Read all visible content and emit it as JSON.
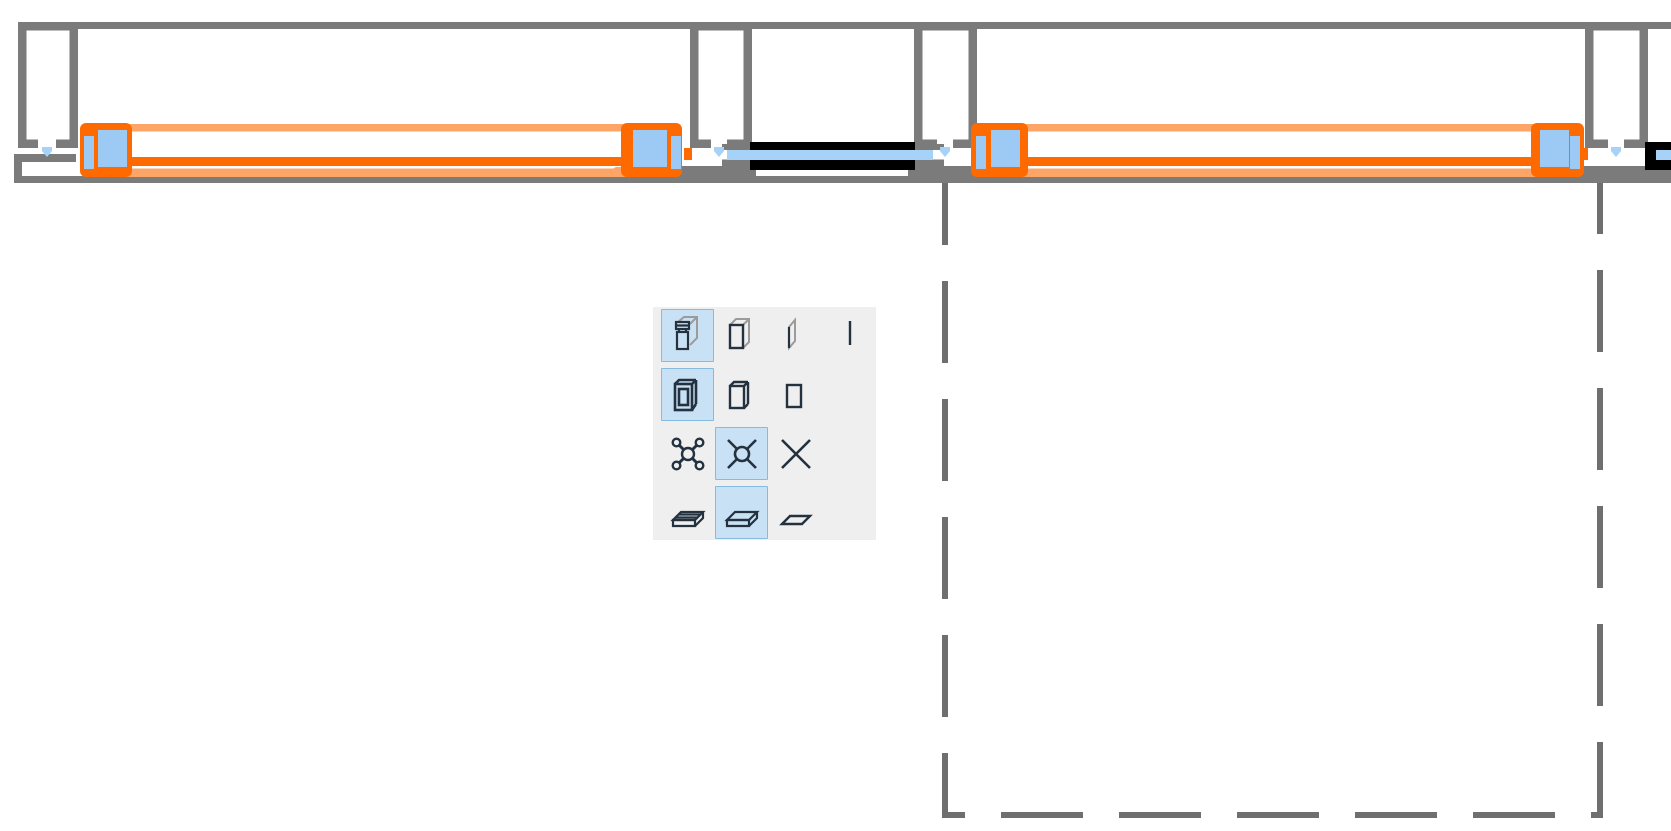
{
  "app": {
    "view": "plan-detail-view",
    "description": "CAD plan view of a wall with glazed openings; two window elements selected (orange) with blue grab handles, one unselected window (black), a dashed selection marquee and a floating display-option palette"
  },
  "colors": {
    "canvas_bg": "#ffffff",
    "wall_gray": "#7b7b7b",
    "marquee_gray": "#6f6f6f",
    "selection_orange": "#ff6a00",
    "selection_orange_light": "#fca566",
    "handle_blue": "#9ccaf5",
    "glass_blue": "#a6d2f8",
    "window_black": "#000000",
    "palette_bg": "#efefef",
    "palette_selected_bg": "#c9e1f4",
    "palette_selected_border": "#85bbe0",
    "icon_dark": "#243240",
    "icon_gray": "#9b9b9b"
  },
  "drawing": {
    "wall": {
      "top_edge_y": 22,
      "bottom_edge_y": 183,
      "piers_x": [
        18,
        690,
        914,
        1585
      ]
    },
    "windows": [
      {
        "state": "selected",
        "x_start": 80,
        "x_end": 682,
        "handles": 2
      },
      {
        "state": "unselected",
        "x_start": 727,
        "x_end": 933
      },
      {
        "state": "selected",
        "x_start": 971,
        "x_end": 1584,
        "handles": 2
      },
      {
        "state": "unselected-partial",
        "x_start": 1645,
        "x_end": 1671
      }
    ],
    "anchor_marks": 4,
    "marquee": {
      "left": 945,
      "top": 183,
      "right": 1600,
      "bottom": 815,
      "style": "dashed"
    }
  },
  "palette": {
    "rows": [
      {
        "cells": [
          {
            "icon": "box-3d-detailed-icon",
            "selected": true
          },
          {
            "icon": "box-3d-simple-icon",
            "selected": false
          },
          {
            "icon": "panel-3d-icon",
            "selected": false
          },
          {
            "icon": "line-2d-icon",
            "selected": false
          }
        ]
      },
      {
        "cells": [
          {
            "icon": "frame-3d-detailed-icon",
            "selected": true
          },
          {
            "icon": "frame-3d-simple-icon",
            "selected": false
          },
          {
            "icon": "rectangle-2d-icon",
            "selected": false
          }
        ]
      },
      {
        "cells": [
          {
            "icon": "cross-nodes-detailed-icon",
            "selected": false
          },
          {
            "icon": "cross-node-simple-icon",
            "selected": true
          },
          {
            "icon": "cross-plain-icon",
            "selected": false
          }
        ]
      },
      {
        "cells": [
          {
            "icon": "slab-3d-detailed-icon",
            "selected": false
          },
          {
            "icon": "slab-3d-simple-icon",
            "selected": true
          },
          {
            "icon": "slab-flat-icon",
            "selected": false
          }
        ]
      }
    ]
  }
}
